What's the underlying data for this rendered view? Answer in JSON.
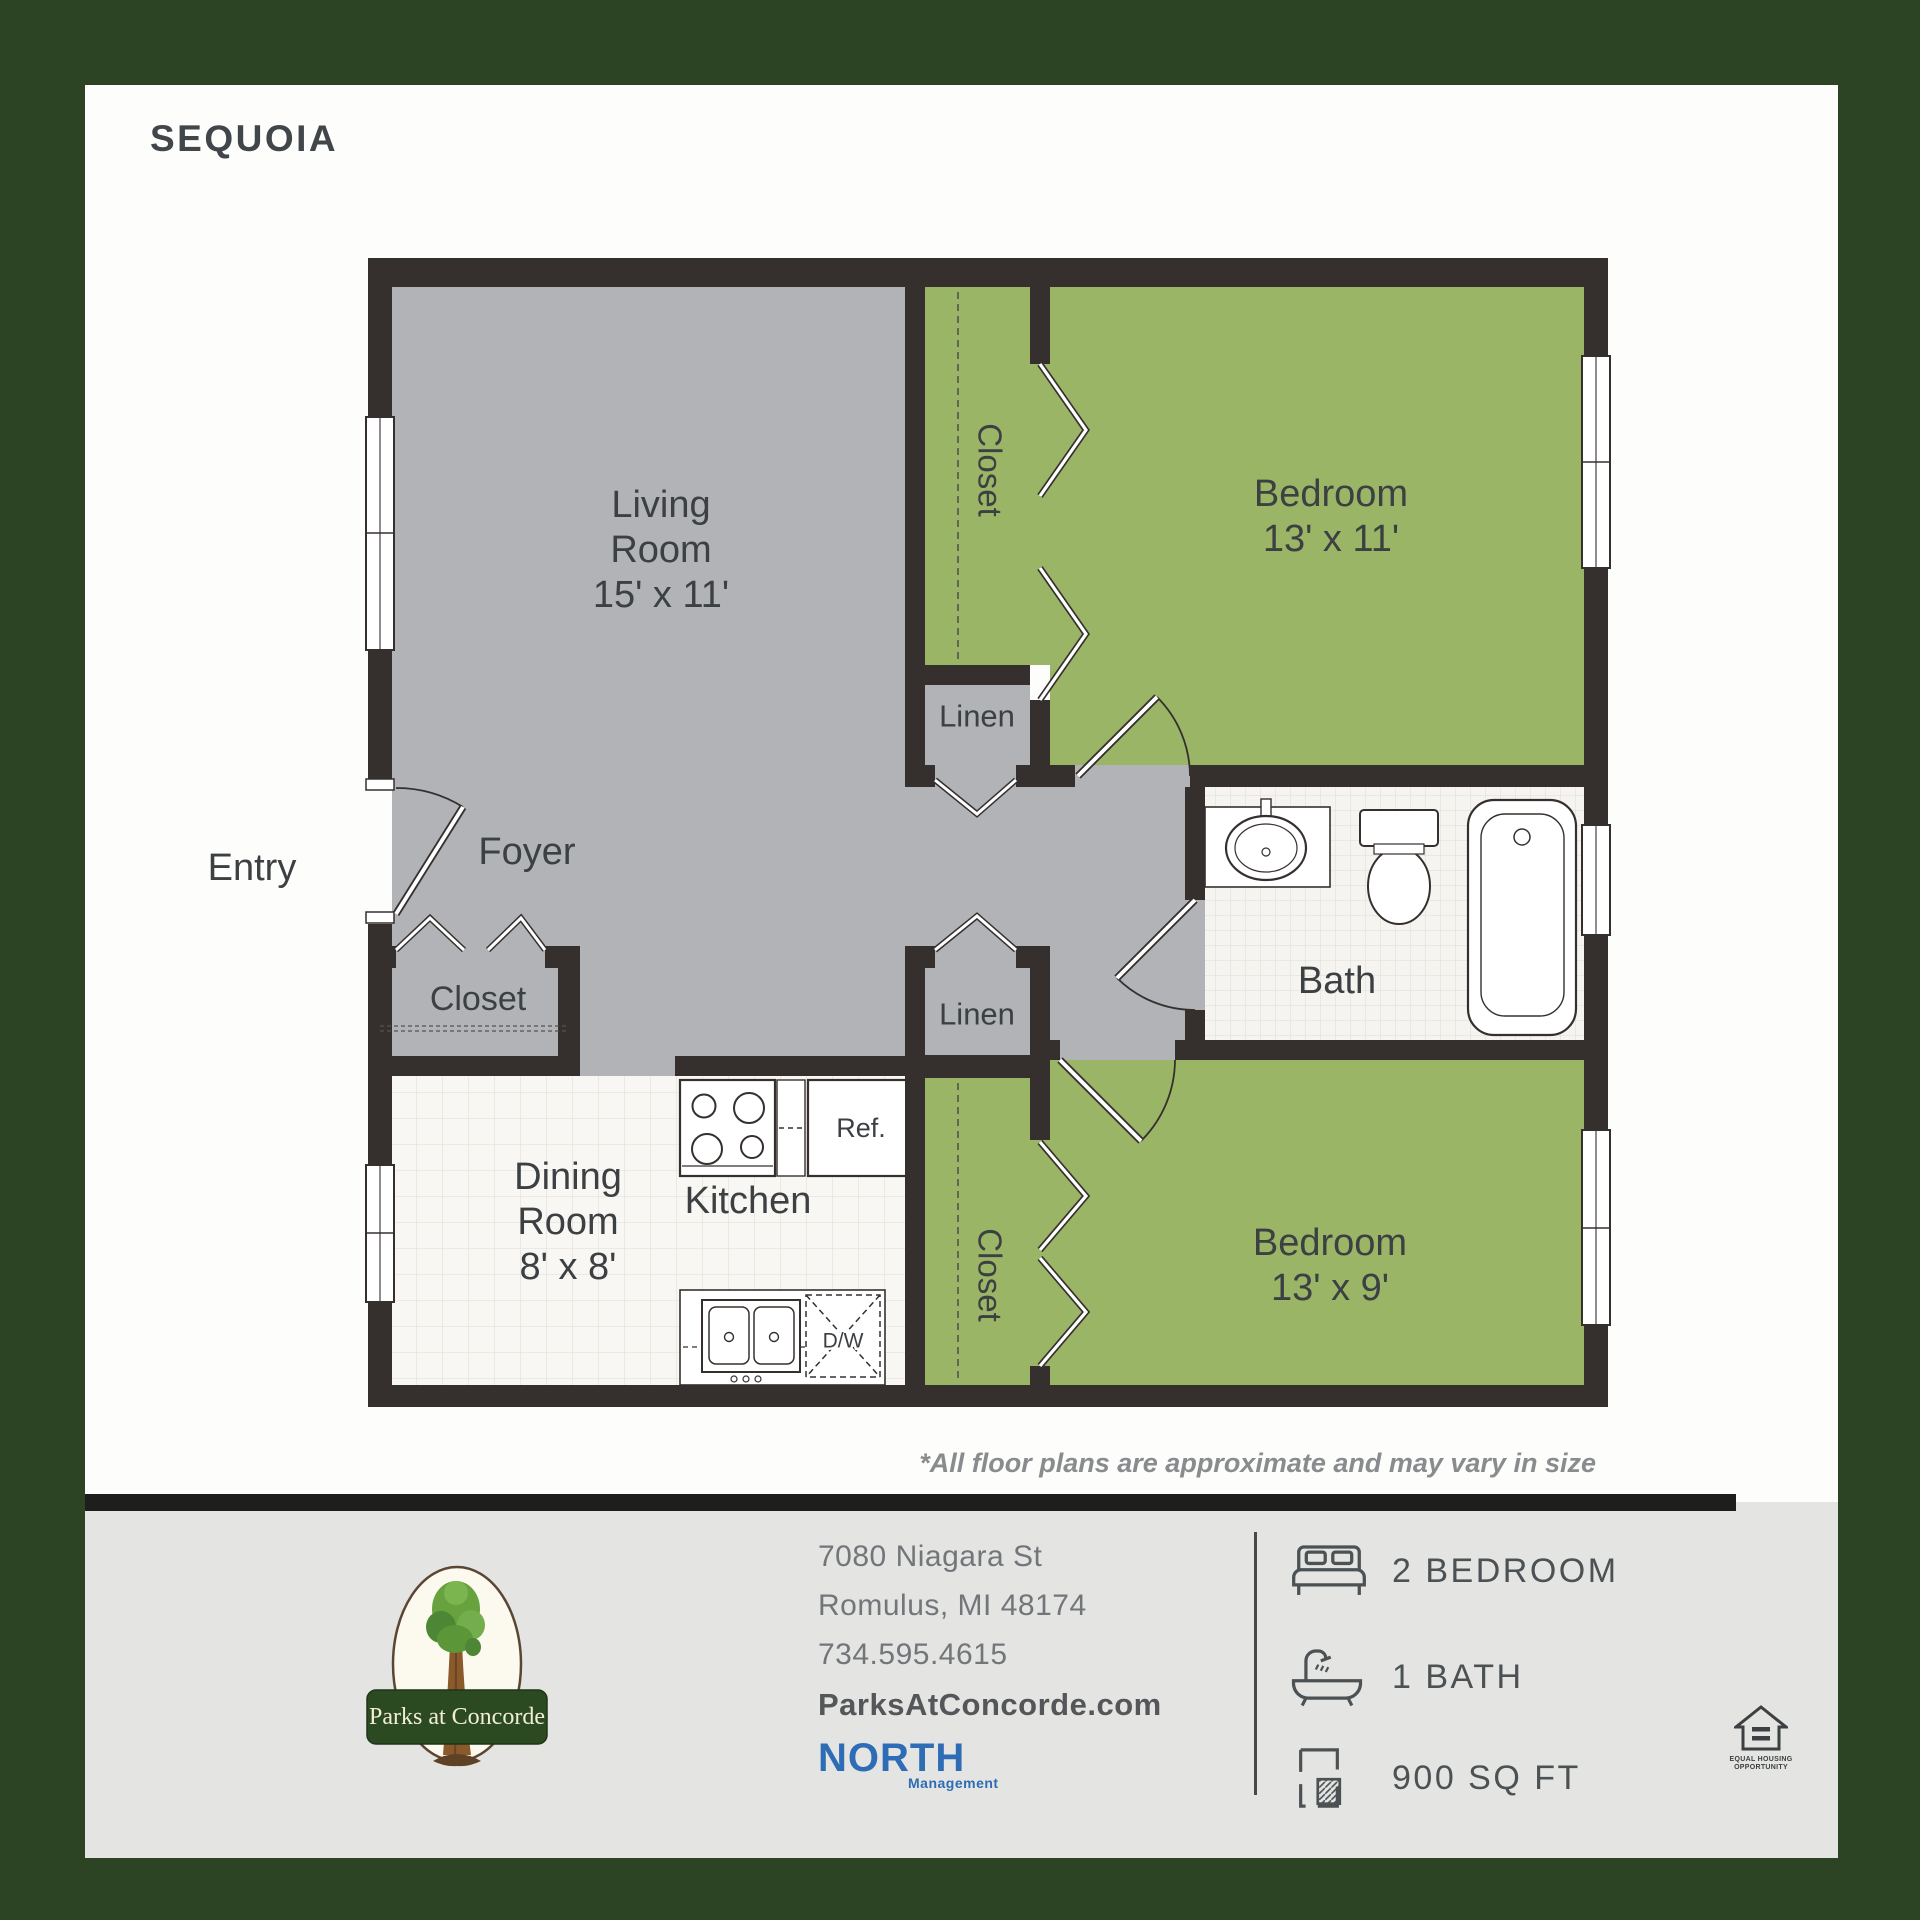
{
  "title": "SEQUOIA",
  "disclaimer": "*All floor plans are approximate and may vary in size",
  "plan": {
    "living": [
      "Living",
      "Room",
      "15' x 11'"
    ],
    "bedroom1": [
      "Bedroom",
      "13' x 11'"
    ],
    "bedroom2": [
      "Bedroom",
      "13' x 9'"
    ],
    "dining": [
      "Dining",
      "Room",
      "8' x 8'"
    ],
    "kitchen": "Kitchen",
    "bath": "Bath",
    "foyer": "Foyer",
    "entry": "Entry",
    "closet": "Closet",
    "linen": "Linen",
    "fridge": "Ref.",
    "dishwasher": "D/W"
  },
  "footer": {
    "logo_name": "Parks at Concorde",
    "address1": "7080 Niagara St",
    "address2": "Romulus, MI 48174",
    "phone": "734.595.4615",
    "website": "ParksAtConcorde.com",
    "management": "NORTH",
    "management_sub": "Management",
    "specs": [
      {
        "icon": "bed-icon",
        "label": "2 BEDROOM"
      },
      {
        "icon": "bathtub-icon",
        "label": "1 BATH"
      },
      {
        "icon": "floorplan-icon",
        "label": "900 SQ FT"
      }
    ],
    "eho1": "EQUAL HOUSING",
    "eho2": "OPPORTUNITY"
  },
  "colors": {
    "border_green": "#2d4424",
    "room_green": "#9bb566",
    "floor_gray": "#b1b3b6",
    "wall": "#35302e",
    "logo_banner_green": "#2c4a22",
    "management_blue": "#2e6cb5"
  }
}
